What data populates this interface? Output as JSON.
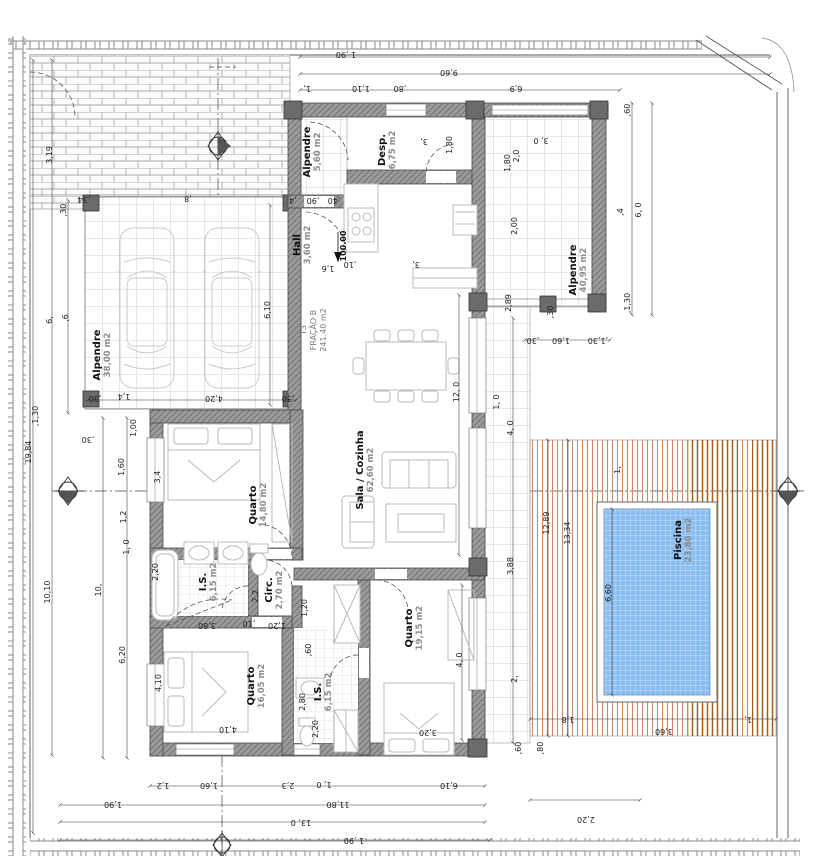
{
  "title": "Planta de arquitetura - Fração B (T3) com piscina",
  "unit_label": {
    "line1": "T3",
    "line2": "FRAÇÃO B",
    "line3": "241.40 m2"
  },
  "level_marker": "100.00",
  "colors": {
    "pool": "#8abdf0",
    "poolLine": "#d8eafc",
    "deck": "#c98d66",
    "deckDark": "#a3611c",
    "wall": "#9b9b9b",
    "wallLine": "#757575",
    "tile": "#c4c4c4",
    "brick": "#ababab",
    "fence": "#8a8a8a",
    "furn": "#b9b9b9",
    "dim": "#1d1d1d",
    "roomName": "#111111",
    "roomArea": "#8c8c8c"
  },
  "rooms": [
    {
      "name": "Alpendre",
      "area": "38,00 m2",
      "x": 100,
      "y": 355,
      "r": -90
    },
    {
      "name": "Alpendre",
      "area": "5,60 m2",
      "x": 310,
      "y": 152,
      "r": -90
    },
    {
      "name": "Desp.",
      "area": "6,75 m2",
      "x": 385,
      "y": 150,
      "r": -90
    },
    {
      "name": "Hall",
      "area": "3,60 m2",
      "x": 300,
      "y": 245,
      "r": -90
    },
    {
      "name": "Sala / Cozinha",
      "area": "62,60 m2",
      "x": 363,
      "y": 470,
      "r": -90
    },
    {
      "name": "Quarto",
      "area": "14,80 m2",
      "x": 256,
      "y": 505,
      "r": -90
    },
    {
      "name": "I.S.",
      "area": "6,15 m2",
      "x": 206,
      "y": 582,
      "r": -90
    },
    {
      "name": "Circ.",
      "area": "2,70 m2",
      "x": 272,
      "y": 590,
      "r": -90
    },
    {
      "name": "Quarto",
      "area": "16,05 m2",
      "x": 254,
      "y": 686,
      "r": -90
    },
    {
      "name": "I.S.",
      "area": "6,15 m2",
      "x": 321,
      "y": 692,
      "r": -90
    },
    {
      "name": "Quarto",
      "area": "19,15 m2",
      "x": 412,
      "y": 628,
      "r": -90
    },
    {
      "name": "Alpendre",
      "area": "40,95 m2",
      "x": 576,
      "y": 270,
      "r": -90
    },
    {
      "name": "Piscina",
      "area": "23,80 m2",
      "x": 681,
      "y": 540,
      "r": -90
    }
  ],
  "dimensions": [
    {
      "t": "1 ,90",
      "x": 346,
      "y": 52,
      "r": 180
    },
    {
      "t": "9,60",
      "x": 449,
      "y": 70,
      "r": 180
    },
    {
      "t": "1,",
      "x": 307,
      "y": 86,
      "r": 180
    },
    {
      "t": "1,10",
      "x": 361,
      "y": 86,
      "r": 180
    },
    {
      "t": ",80",
      "x": 400,
      "y": 86,
      "r": 180
    },
    {
      "t": "6,9",
      "x": 516,
      "y": 86,
      "r": 180
    },
    {
      "t": ",8",
      "x": 188,
      "y": 196,
      "r": 180
    },
    {
      "t": ",34",
      "x": 84,
      "y": 197,
      "r": 180
    },
    {
      "t": ",60",
      "x": 630,
      "y": 110,
      "r": -90
    },
    {
      "t": ",4",
      "x": 623,
      "y": 212,
      "r": -90
    },
    {
      "t": "6, 0",
      "x": 641,
      "y": 210,
      "r": -90
    },
    {
      "t": ",1,30",
      "x": 630,
      "y": 303,
      "r": -90
    },
    {
      "t": "3, 0",
      "x": 541,
      "y": 138,
      "r": 180
    },
    {
      "t": "2,0",
      "x": 519,
      "y": 156,
      "r": -90
    },
    {
      "t": "2,00",
      "x": 517,
      "y": 226,
      "r": -90
    },
    {
      "t": "2,89",
      "x": 511,
      "y": 303,
      "r": -90
    },
    {
      "t": "1,80",
      "x": 452,
      "y": 145,
      "r": -90
    },
    {
      "t": "3,",
      "x": 424,
      "y": 139,
      "r": 180
    },
    {
      "t": ",30",
      "x": 533,
      "y": 338,
      "r": 180
    },
    {
      "t": "1,60",
      "x": 561,
      "y": 338,
      "r": 180
    },
    {
      "t": ",1,30",
      "x": 598,
      "y": 338,
      "r": 180
    },
    {
      "t": ",30",
      "x": 553,
      "y": 312,
      "r": -90
    },
    {
      "t": "12,89",
      "x": 549,
      "y": 523,
      "r": -90
    },
    {
      "t": "13,34",
      "x": 570,
      "y": 533,
      "r": -90
    },
    {
      "t": "3,88",
      "x": 513,
      "y": 566,
      "r": -90
    },
    {
      "t": "4, 0",
      "x": 513,
      "y": 428,
      "r": -90
    },
    {
      "t": "1, 0",
      "x": 499,
      "y": 402,
      "r": -90
    },
    {
      "t": "2,",
      "x": 517,
      "y": 679,
      "r": -90
    },
    {
      "t": "1,",
      "x": 620,
      "y": 470,
      "r": -90
    },
    {
      "t": "6,60",
      "x": 611,
      "y": 593,
      "r": -90
    },
    {
      "t": "1,8",
      "x": 568,
      "y": 717,
      "r": 180
    },
    {
      "t": "3,60",
      "x": 664,
      "y": 729,
      "r": 180
    },
    {
      "t": "1,",
      "x": 748,
      "y": 717,
      "r": 180
    },
    {
      "t": "2,20",
      "x": 586,
      "y": 817,
      "r": 180
    },
    {
      "t": ",60",
      "x": 521,
      "y": 748,
      "r": -90
    },
    {
      "t": ",80",
      "x": 543,
      "y": 748,
      "r": -90
    },
    {
      "t": "19,84",
      "x": 31,
      "y": 452,
      "r": -90
    },
    {
      "t": "3,19",
      "x": 52,
      "y": 155,
      "r": -90
    },
    {
      "t": ",30",
      "x": 66,
      "y": 210,
      "r": -90
    },
    {
      "t": "6,",
      "x": 52,
      "y": 320,
      "r": -90
    },
    {
      "t": ",6",
      "x": 68,
      "y": 318,
      "r": -90
    },
    {
      "t": ",1,30",
      "x": 38,
      "y": 416,
      "r": -90
    },
    {
      "t": "10,10",
      "x": 50,
      "y": 592,
      "r": -90
    },
    {
      "t": "10,",
      "x": 101,
      "y": 590,
      "r": -90
    },
    {
      "t": "1,60",
      "x": 124,
      "y": 467,
      "r": -90
    },
    {
      "t": "1,2",
      "x": 126,
      "y": 517,
      "r": -90
    },
    {
      "t": "1, 0",
      "x": 129,
      "y": 547,
      "r": -90
    },
    {
      "t": "6,20",
      "x": 125,
      "y": 655,
      "r": -90
    },
    {
      "t": "1,00",
      "x": 136,
      "y": 428,
      "r": -90
    },
    {
      "t": ",30",
      "x": 88,
      "y": 437,
      "r": 180
    },
    {
      "t": "3,4",
      "x": 160,
      "y": 477,
      "r": -90
    },
    {
      "t": "2,20",
      "x": 158,
      "y": 572,
      "r": -90
    },
    {
      "t": "4,10",
      "x": 161,
      "y": 683,
      "r": -90
    },
    {
      "t": "6,10",
      "x": 270,
      "y": 310,
      "r": -90
    },
    {
      "t": "4,20",
      "x": 214,
      "y": 396,
      "r": 180
    },
    {
      "t": "1,4",
      "x": 124,
      "y": 394,
      "r": 180
    },
    {
      "t": ",30",
      "x": 95,
      "y": 396,
      "r": 180
    },
    {
      "t": ",30",
      "x": 288,
      "y": 396,
      "r": 180
    },
    {
      "t": ",4",
      "x": 293,
      "y": 198,
      "r": 180
    },
    {
      "t": ",90",
      "x": 313,
      "y": 198,
      "r": 180
    },
    {
      "t": ",40",
      "x": 334,
      "y": 198,
      "r": 180
    },
    {
      "t": "1,6",
      "x": 328,
      "y": 266,
      "r": 180
    },
    {
      "t": ",10",
      "x": 350,
      "y": 262,
      "r": 180
    },
    {
      "t": "3,",
      "x": 416,
      "y": 262,
      "r": 180
    },
    {
      "t": "12, 0",
      "x": 459,
      "y": 392,
      "r": -90
    },
    {
      "t": "4, 0",
      "x": 462,
      "y": 660,
      "r": -90
    },
    {
      "t": "3,20",
      "x": 428,
      "y": 730,
      "r": 180
    },
    {
      "t": "2,20",
      "x": 318,
      "y": 729,
      "r": -90
    },
    {
      "t": "4,10",
      "x": 228,
      "y": 727,
      "r": 180
    },
    {
      "t": "2,80",
      "x": 305,
      "y": 702,
      "r": -90
    },
    {
      "t": "2,2",
      "x": 258,
      "y": 596,
      "r": -90
    },
    {
      "t": "1,20",
      "x": 277,
      "y": 623,
      "r": 180
    },
    {
      "t": ",10",
      "x": 249,
      "y": 621,
      "r": 180
    },
    {
      "t": "3,80",
      "x": 207,
      "y": 623,
      "r": 180
    },
    {
      "t": "1,20",
      "x": 307,
      "y": 608,
      "r": -90
    },
    {
      "t": ",60",
      "x": 311,
      "y": 650,
      "r": -90
    },
    {
      "t": "1,80",
      "x": 510,
      "y": 163,
      "r": -90
    },
    {
      "t": "1,2",
      "x": 163,
      "y": 783,
      "r": 180
    },
    {
      "t": "1,60",
      "x": 209,
      "y": 783,
      "r": 180
    },
    {
      "t": "2,3",
      "x": 288,
      "y": 783,
      "r": 180
    },
    {
      "t": "1, 0",
      "x": 324,
      "y": 782,
      "r": 180
    },
    {
      "t": "6,10",
      "x": 449,
      "y": 783,
      "r": 180
    },
    {
      "t": "1,90",
      "x": 113,
      "y": 802,
      "r": 180
    },
    {
      "t": "11,80",
      "x": 338,
      "y": 802,
      "r": 180
    },
    {
      "t": "13, 0",
      "x": 301,
      "y": 820,
      "r": 180
    },
    {
      "t": "1 ,90",
      "x": 354,
      "y": 838,
      "r": 180
    }
  ]
}
